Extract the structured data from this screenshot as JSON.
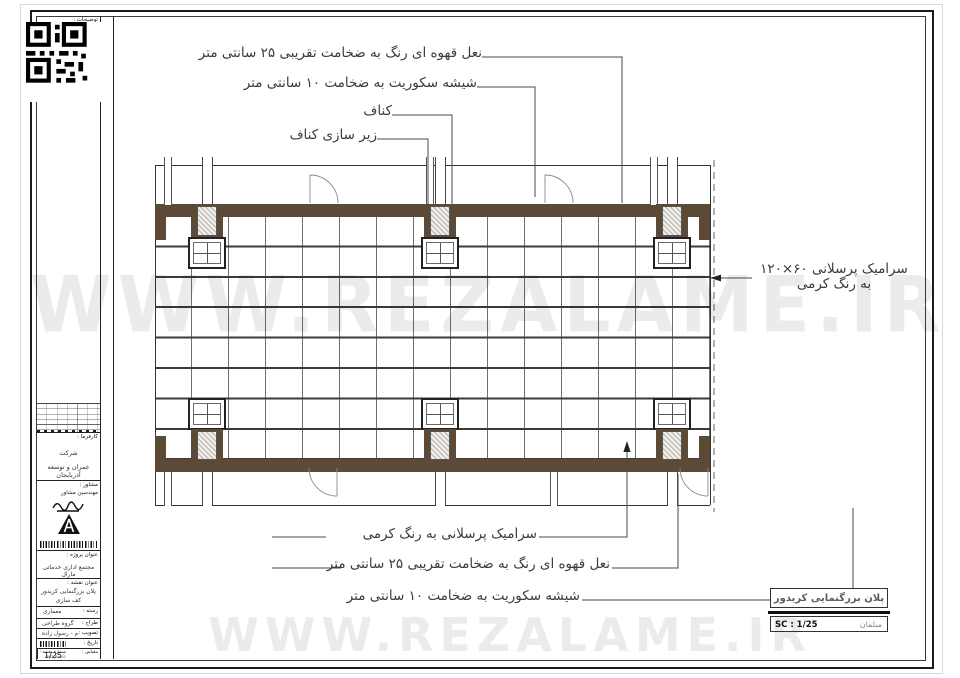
{
  "annotations": {
    "top": [
      {
        "text": "نعل قهوه ای رنگ به ضخامت تقریبی ۲۵ سانتی متر"
      },
      {
        "text": "شیشه سکوریت به ضخامت ۱۰ سانتی متر"
      },
      {
        "text": "کناف"
      },
      {
        "text": "زیر سازی کناف"
      }
    ],
    "right": {
      "line1": "سرامیک پرسلانی ۶۰×۱۲۰",
      "line2": "به رنگ کرمی"
    },
    "bottom": [
      {
        "text": "سرامیک پرسلانی به رنگ کرمی"
      },
      {
        "text": "نعل قهوه ای رنگ به ضخامت تقریبی ۲۵ سانتی متر"
      },
      {
        "text": "شیشه سکوریت به ضخامت ۱۰ سانتی متر"
      }
    ]
  },
  "title_block": {
    "notes_label": "توضیحات :",
    "client_label": "کارفرما :",
    "client_name_line1": "شرکت",
    "client_name_line2": "عمران و توسعه آذربایجان",
    "consultant_label": "مشاور :",
    "consultant_name": "مهندسین مشاور",
    "project_label": "عنوان پروژه :",
    "project_name": "مجتمع اداری خدماتی مارال",
    "sheet_label": "عنوان نقشه :",
    "sheet_title_line1": "پلان بزرگنمایی کریدور",
    "sheet_title_line2": "کف سازی",
    "rows": [
      {
        "label": "رسته :",
        "value": "معماری"
      },
      {
        "label": "طراح :",
        "value": "گروه طراحی"
      },
      {
        "label": "تصویب :",
        "value": "م - رسول زاده"
      },
      {
        "label": "تاریخ :",
        "value": ""
      }
    ],
    "sheet_no_label": "شماره نقشه :",
    "sheet_no_value": "R02_Rev01",
    "scale_label": "مقیاس :",
    "scale_value": "1/25"
  },
  "footer": {
    "title": "پلان بزرگنمایی کریدور",
    "scale": "SC : 1/25",
    "layer": "مبلمان"
  },
  "watermark": {
    "text": "WWW.REZALAME.IR"
  },
  "colors": {
    "band": "#5c4a37",
    "line": "#3a3a3a",
    "watermark": "#e4e4e4"
  }
}
